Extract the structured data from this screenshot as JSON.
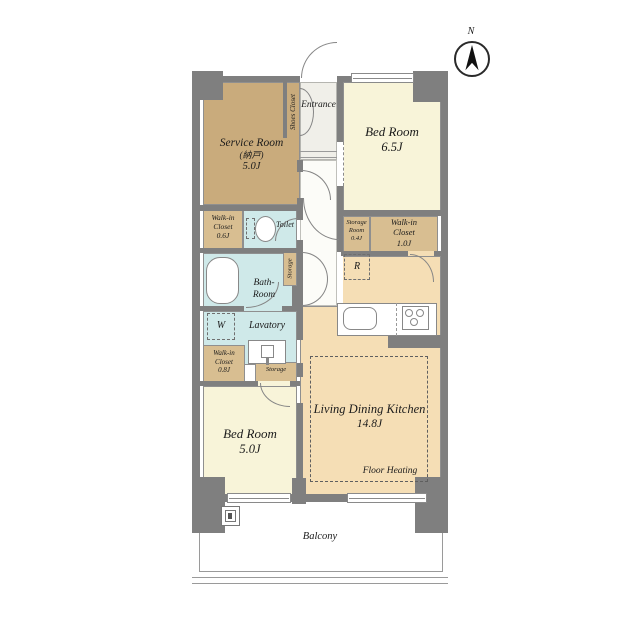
{
  "compass": {
    "north_label": "N"
  },
  "rooms": {
    "service_room": {
      "line1": "Service Room",
      "line2": "(納戸)",
      "line3": "5.0J"
    },
    "shoes_closet": {
      "label": "Shoes Closet"
    },
    "entrance": {
      "label": "Entrance"
    },
    "bedroom_65": {
      "line1": "Bed Room",
      "line2": "6.5J"
    },
    "wic_06": {
      "line1": "Walk-in",
      "line2": "Closet",
      "line3": "0.6J"
    },
    "toilet": {
      "label": "Toilet"
    },
    "storage_room_04": {
      "line1": "Storage",
      "line2": "Room",
      "line3": "0.4J"
    },
    "wic_10": {
      "line1": "Walk-in",
      "line2": "Closet",
      "line3": "1.0J"
    },
    "bath": {
      "line1": "Bath-",
      "line2": "Room"
    },
    "hall_storage": {
      "label": "Storage"
    },
    "refrigerator": {
      "label": "R"
    },
    "washer": {
      "label": "W"
    },
    "lavatory": {
      "label": "Lavatory"
    },
    "wic_08": {
      "line1": "Walk-in",
      "line2": "Closet",
      "line3": "0.8J"
    },
    "small_storage": {
      "label": "Storage"
    },
    "bedroom_50": {
      "line1": "Bed Room",
      "line2": "5.0J"
    },
    "ldk": {
      "line1": "Living Dining Kitchen",
      "line2": "14.8J",
      "note": "Floor Heating"
    },
    "balcony": {
      "label": "Balcony"
    }
  },
  "colors": {
    "wall": "#7f7f7f",
    "service_room_fill": "#c9ab7c",
    "closet_fill": "#d8be91",
    "bedroom_fill": "#f8f4d9",
    "ldk_fill": "#f5deb5",
    "wet_area_fill": "#cfe9e9",
    "entrance_fill": "#f0efe9",
    "outline": "#8a8a8a"
  }
}
